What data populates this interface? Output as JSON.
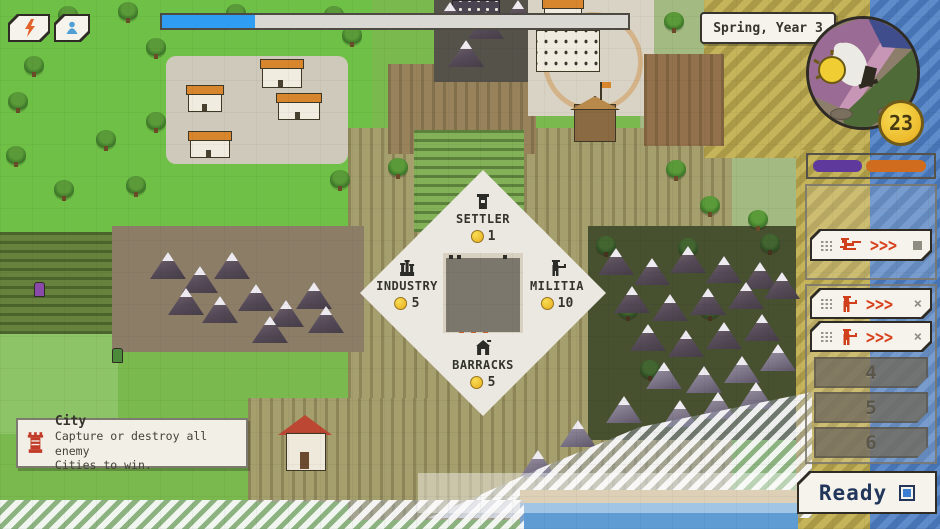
{
  "hud": {
    "turn_label": "Spring, Year 3",
    "progress_value": "20%",
    "progress_color": "#2f9df2",
    "coin_count": "23",
    "ready_label": "Ready",
    "top_buttons": [
      {
        "icon": "lightning-icon",
        "color": "#e2632a"
      },
      {
        "icon": "unit-icon",
        "color": "#4f9fd4"
      }
    ]
  },
  "score_bar": {
    "left_color": "#5f3a9c",
    "right_color": "#cf6c1e",
    "left_width": "42%",
    "right_width": "52%"
  },
  "radial_menu": {
    "coin_color": "#f0c13b",
    "options": [
      {
        "position": "top",
        "label": "SETTLER",
        "cost": "1",
        "icon": "settler-icon"
      },
      {
        "position": "left",
        "label": "INDUSTRY",
        "cost": "5",
        "icon": "industry-icon"
      },
      {
        "position": "right",
        "label": "MILITIA",
        "cost": "10",
        "icon": "militia-icon"
      },
      {
        "position": "bottom",
        "label": "BARRACKS",
        "cost": "5",
        "icon": "barracks-icon"
      }
    ]
  },
  "queue": {
    "accent_color": "#d8431f",
    "rows": [
      {
        "icon": "sniper-unit-icon",
        "chevrons": ">>>",
        "control": "hold-icon"
      },
      {
        "icon": "soldier-unit-icon",
        "chevrons": ">>>",
        "control": "dismiss",
        "dismiss_label": "×"
      },
      {
        "icon": "soldier-unit-icon",
        "chevrons": ">>>",
        "control": "dismiss",
        "dismiss_label": "×"
      }
    ],
    "empty_slots": [
      "4",
      "5",
      "6"
    ]
  },
  "tooltip": {
    "icon": "city-icon",
    "title": "City",
    "body_line1": "Capture or destroy all enemy",
    "body_line2": "Cities to win."
  }
}
